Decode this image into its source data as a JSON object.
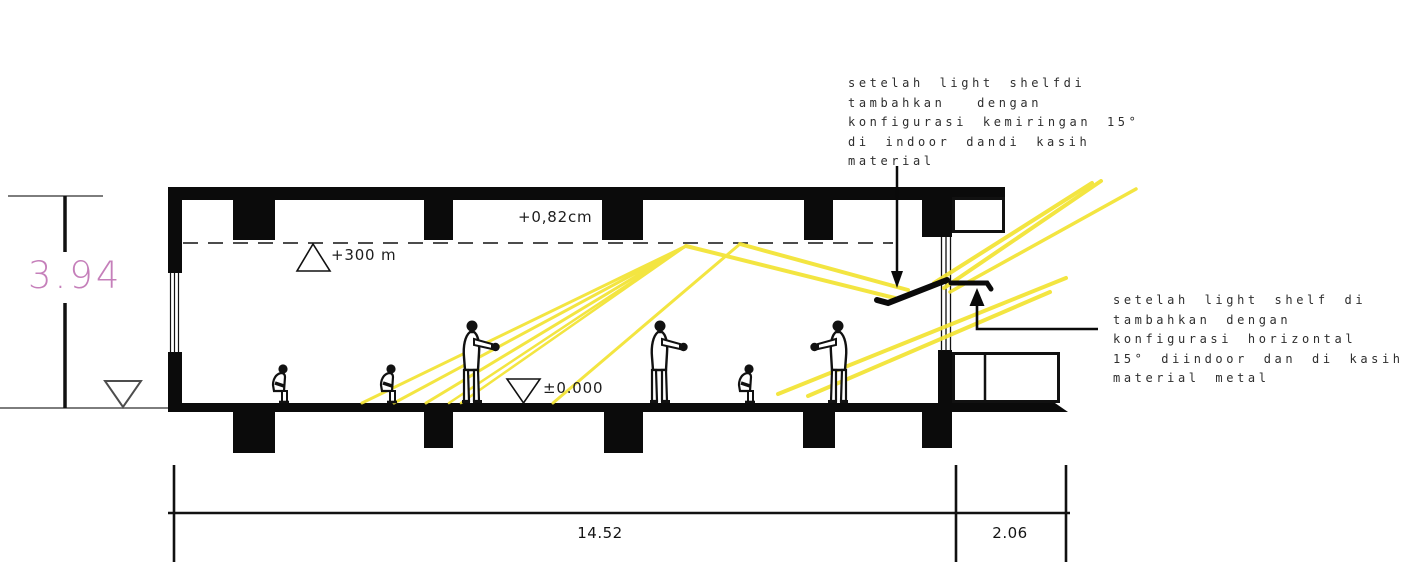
{
  "annotations": {
    "top": {
      "lines": [
        "setelah light shelfdi",
        "tambahkan  dengan",
        "konfigurasi kemiringan 15°",
        "di indoor dandi kasih",
        "material"
      ]
    },
    "right": {
      "lines": [
        "setelah light shelf di",
        "tambahkan dengan",
        "konfigurasi horizontal",
        "15° diindoor dan di kasih",
        "material metal"
      ]
    }
  },
  "levels": {
    "ceiling_offset": "+0,82cm",
    "ceiling_height": "+300 m",
    "floor_level": "±0.000"
  },
  "dimensions": {
    "section_height": "3.94",
    "main_span": "14.52",
    "annex_span": "2.06"
  },
  "colors": {
    "light_ray": "#f2e331",
    "height_dim_text": "#c57fba",
    "ink": "#111111",
    "reference_line": "#7d7d7d"
  }
}
